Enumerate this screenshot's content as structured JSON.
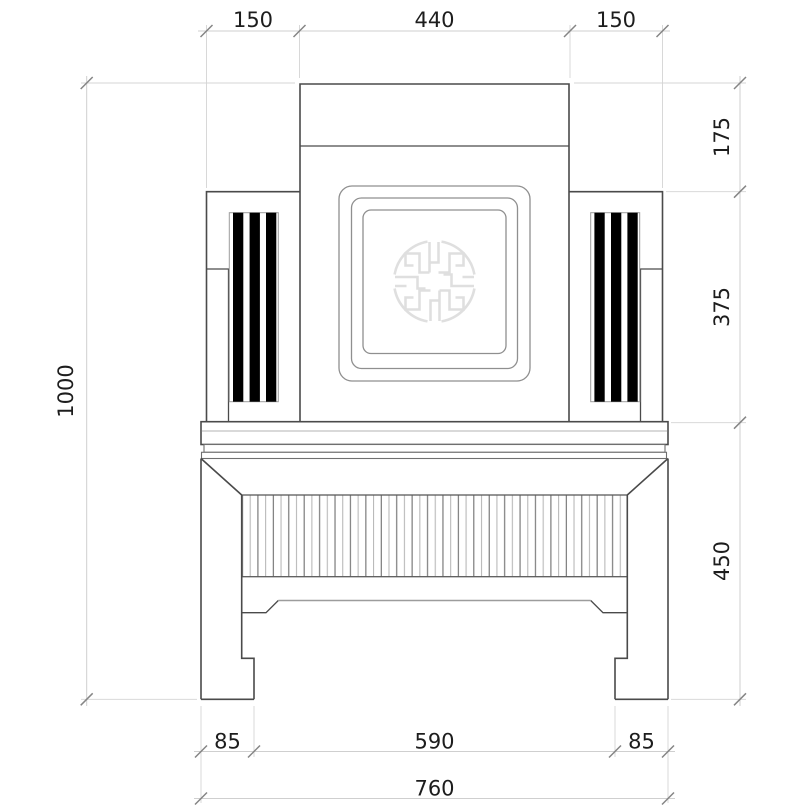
{
  "drawing": {
    "dims": {
      "top": {
        "left": "150",
        "center": "440",
        "right": "150"
      },
      "right_side": {
        "upper": "175",
        "middle": "375",
        "lower": "450"
      },
      "left_side": {
        "overall_height": "1000"
      },
      "bottom": {
        "left": "85",
        "center": "590",
        "right": "85"
      },
      "bottom_overall": {
        "width": "760"
      }
    },
    "colors": {
      "background": "#ffffff",
      "outline": "#4a4a4a",
      "secondary_line": "#8f8f8f",
      "dimension_line": "#cfcfcf",
      "tick": "#858585",
      "label_text": "#1d1d1d",
      "stripe": "#000000",
      "medallion": "#dfdfdf"
    }
  }
}
